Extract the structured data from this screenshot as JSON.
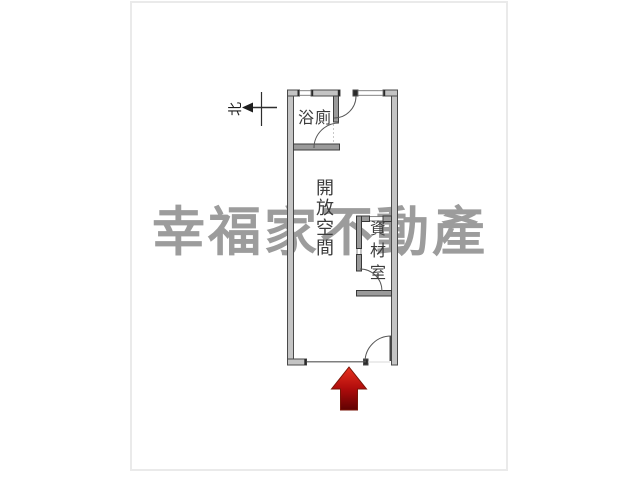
{
  "page": {
    "background": "#ffffff",
    "frame_border": "#eaeaea"
  },
  "watermark": {
    "text": "幸福家不動產",
    "color": "#9c9c9c"
  },
  "floor_plan": {
    "north_label": "北",
    "rooms": [
      {
        "id": "bathroom",
        "label": "浴廁"
      },
      {
        "id": "open-space",
        "label": "開放空間"
      },
      {
        "id": "storage",
        "label": "資材室"
      }
    ],
    "colors": {
      "wall_fill": "#c4c4c4",
      "partition_fill": "#9a9a9a",
      "wall_stroke": "#4a4a4a",
      "thin_line": "#555555",
      "label_text": "#3c3c3c"
    },
    "entrance_arrow": {
      "direction": "up",
      "color_top": "#e8321e",
      "color_mid": "#b00c0c",
      "color_bottom": "#5f0202",
      "outline": "#7a1508"
    }
  }
}
